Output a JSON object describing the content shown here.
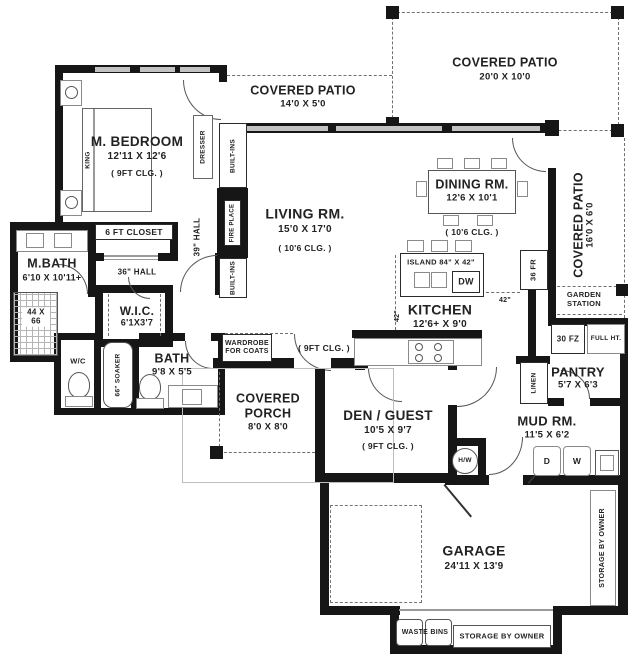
{
  "rooms": {
    "m_bedroom": {
      "name": "M. BEDROOM",
      "dims": "12'11 X 12'6",
      "ceiling": "( 9FT CLG. )"
    },
    "living": {
      "name": "LIVING RM.",
      "dims": "15'0 X 17'0",
      "ceiling": "( 10'6 CLG. )"
    },
    "dining": {
      "name": "DINING RM.",
      "dims": "12'6 X 10'1",
      "ceiling": "( 10'6 CLG. )"
    },
    "kitchen": {
      "name": "KITCHEN",
      "dims": "12'6+ X 9'0"
    },
    "m_bath": {
      "name": "M.BATH",
      "dims": "6'10 X 10'11+"
    },
    "wic": {
      "name": "W.I.C.",
      "dims": "6'1X3'7"
    },
    "bath": {
      "name": "BATH",
      "dims": "9'8 X 5'5"
    },
    "den": {
      "name": "DEN / GUEST",
      "dims": "10'5 X 9'7",
      "ceiling": "( 9FT CLG. )"
    },
    "mud": {
      "name": "MUD RM.",
      "dims": "11'5 X 6'2"
    },
    "pantry": {
      "name": "PANTRY",
      "dims": "5'7 X 6'3"
    },
    "garage": {
      "name": "GARAGE",
      "dims": "24'11 X 13'9"
    },
    "porch": {
      "name": "COVERED PORCH",
      "dims": "8'0 X 8'0"
    },
    "patio_top": {
      "name": "COVERED PATIO",
      "dims": "14'0 X 5'0"
    },
    "patio_ne": {
      "name": "COVERED PATIO",
      "dims": "20'0 X 10'0"
    },
    "patio_east": {
      "name": "COVERED PATIO",
      "dims": "16'0 X 6'0"
    }
  },
  "labels": {
    "king": "KING",
    "dresser": "DRESSER",
    "closet6": "6 FT CLOSET",
    "hall39": "39\" HALL",
    "hall36": "36\" HALL",
    "built_ins": "BUILT-INS",
    "fireplace": "FIRE PLACE",
    "shower": "44 X 66",
    "wc": "W/C",
    "soaker": "66\" SOAKER",
    "island": "ISLAND 84\" X 42\"",
    "dw": "DW",
    "fridge": "36 FR",
    "clearance": "42\"",
    "garden_station": "GARDEN STATION",
    "freezer": "30 FZ",
    "full_height": "FULL HT.",
    "linen": "LINEN",
    "dryer": "D",
    "washer": "W",
    "water_heater": "H/W",
    "wardrobe": "WARDROBE FOR COATS",
    "entry_ceiling": "( 9FT CLG. )",
    "waste_bins": "WASTE BINS",
    "storage": "STORAGE BY OWNER"
  }
}
